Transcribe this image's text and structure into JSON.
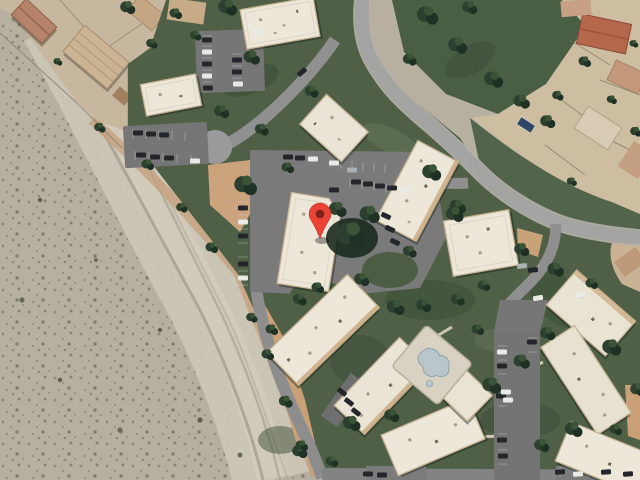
{
  "map": {
    "view": "satellite",
    "marker": {
      "color": "#EA4335",
      "dot_color": "#7F231A",
      "transform": "translate(320,239)"
    },
    "features": {
      "desert_wash": "desert wash with scrub vegetation",
      "flood_channel": "graded sandy flood channel with tire tracks",
      "apartment_complex": "apartment buildings with white flat roofs",
      "pool": "free-form swimming pool with deck",
      "cul_de_sac": "cul-de-sac turnaround",
      "main_road": "curving residential street",
      "parking": "surface parking lots with parked cars",
      "homes_northwest": "single-family homes on dirt lots",
      "homes_east": "single-family homes with tile roofs",
      "lawn": "landscaped lawns with mature trees"
    },
    "palette": {
      "desert_sand": "#BCB5A5",
      "channel_sand": "#CCC6B7",
      "lawn_green": "#4F6047",
      "tree_green": "#2C4030",
      "road_gray": "#A4A4A2",
      "parking_gray": "#767676",
      "roof_white": "#ECE7D9",
      "roof_terracotta": "#B5674C",
      "dirt_tan": "#C9A078",
      "pool_water": "#B9C7CB"
    }
  }
}
